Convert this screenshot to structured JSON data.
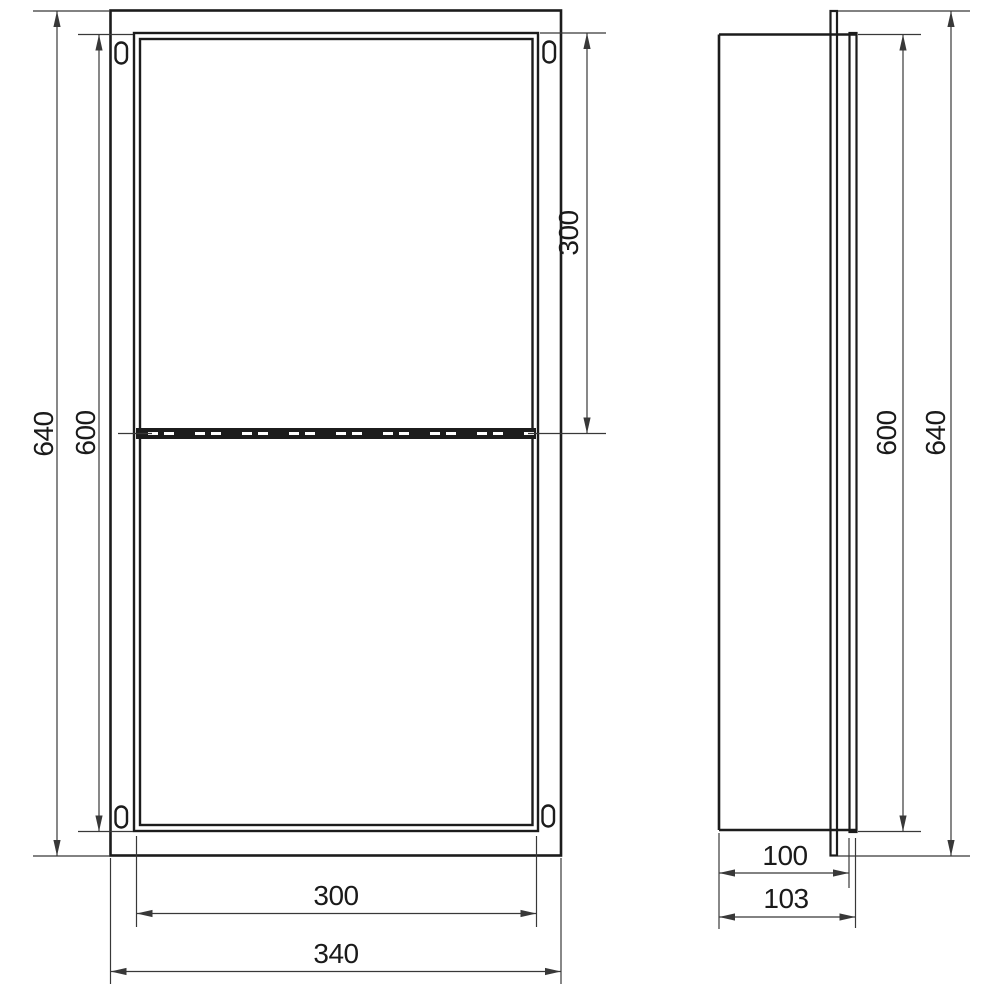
{
  "diagram": {
    "type": "technical-drawing",
    "subject": "wall niche with middle shelf, two orthographic views",
    "views": [
      {
        "name": "front view",
        "features": [
          "outer flange rectangle",
          "double-line inner frame",
          "middle shelf shown with dashed hidden line",
          "four oval mounting slots in flange corners"
        ]
      },
      {
        "name": "side view",
        "features": [
          "niche body profile",
          "tall front flange plate",
          "protruding front rim"
        ]
      }
    ],
    "dimensions": {
      "front_view": [
        {
          "label": "640",
          "measures": "overall height (outer flange)"
        },
        {
          "label": "600",
          "measures": "opening height"
        },
        {
          "label": "300",
          "measures": "upper compartment height, top edge to shelf"
        },
        {
          "label": "300",
          "measures": "opening width"
        },
        {
          "label": "340",
          "measures": "overall width (outer flange)"
        }
      ],
      "side_view": [
        {
          "label": "100",
          "measures": "body depth"
        },
        {
          "label": "103",
          "measures": "total depth including front rim"
        },
        {
          "label": "600",
          "measures": "body height"
        },
        {
          "label": "640",
          "measures": "flange height"
        }
      ]
    }
  },
  "labels": {
    "front_overall_height": "640",
    "front_inner_height": "600",
    "front_upper_section_height": "300",
    "front_inner_width": "300",
    "front_overall_width": "340",
    "side_body_depth": "100",
    "side_total_depth": "103",
    "side_inner_height": "600",
    "side_overall_height": "640"
  },
  "colors": {
    "object_line": "#1c1c1c",
    "dimension_line": "#383838",
    "background": "#ffffff"
  }
}
